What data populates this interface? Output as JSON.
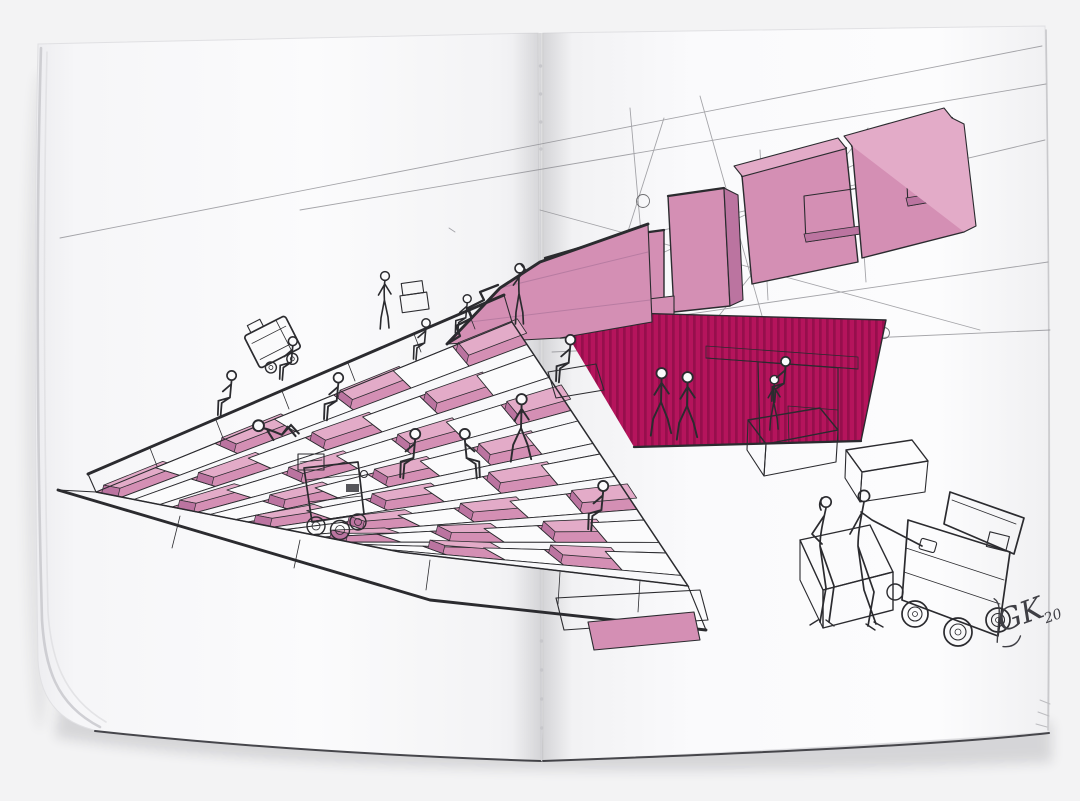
{
  "image": {
    "kind": "photo of an open sketchbook spread",
    "subject": "hand-drawn architectural concept sketch: checkerboard stepped plaza with seated figures, delivery robot carts, striped magenta storefront and blocky pink signage drawn in perspective",
    "signature_initials": "GK",
    "signature_year": "20"
  },
  "scene_elements": [
    "amphitheater-steps",
    "ridge-walkway",
    "base-walkway",
    "pink-ramp",
    "signage-letter-blocks",
    "construction-lines",
    "magenta-facade",
    "doorway",
    "people",
    "stair-climbing-cart",
    "robot-delivery-cart",
    "cargo-cart",
    "boxes",
    "bench-couple",
    "artist-signature",
    "page-fold-stitching"
  ],
  "colors": {
    "backdrop": "#f3f3f4",
    "paper": "#fbfbfc",
    "paper_shade": "#ededf0",
    "page_edge": "#bfbfc3",
    "fold_shadow": "#d8d8db",
    "ink": "#2b2b2f",
    "pencil": "#8d8d92",
    "pink": "#d48fb4",
    "pink_light": "#e3abc8",
    "pink_dark": "#bb74a0",
    "magenta": "#b5145c",
    "magenta_stripe": "#960f4c",
    "hatch_gray": "#ababaf",
    "hatch_dark": "#55555a",
    "cast_shadow": "#9a9aa0"
  }
}
